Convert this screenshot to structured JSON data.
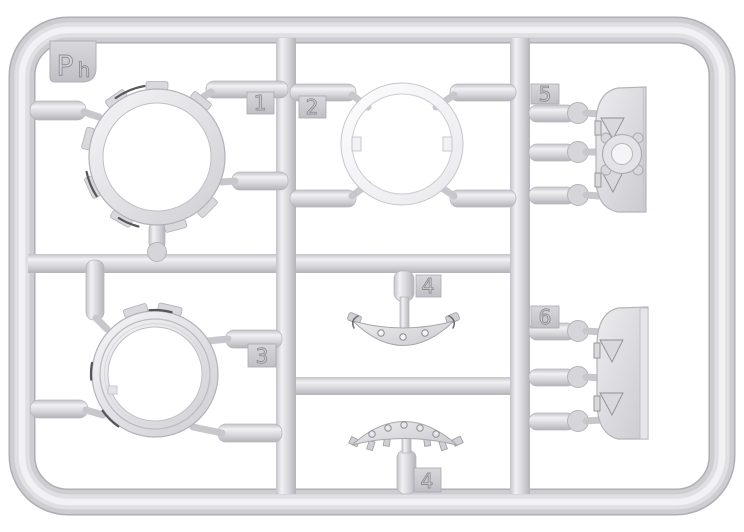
{
  "sprue_code": "Ph",
  "parts": {
    "ring_notched": {
      "number": "1"
    },
    "ring_plain": {
      "number": "2"
    },
    "ring_grooved": {
      "number": "3"
    },
    "arc_riveted_upper": {
      "number": "4"
    },
    "arc_riveted_lower": {
      "number": "4"
    },
    "mount_semicircular": {
      "number": "5"
    },
    "plate_semicircular": {
      "number": "6"
    }
  },
  "colors": {
    "background": "#ffffff",
    "plastic": "#d6d6da",
    "plastic_light": "#f1f1f4",
    "plastic_shadow": "#b3b3b9",
    "accent_dark": "#55555b"
  }
}
